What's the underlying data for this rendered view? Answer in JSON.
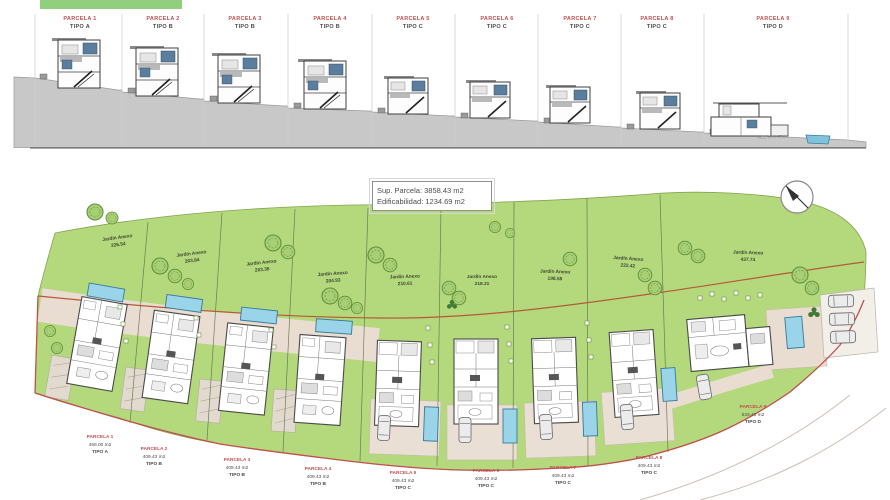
{
  "elevations": {
    "panels": [
      {
        "parcela": "PARCELA 1",
        "tipo": "TIPO A"
      },
      {
        "parcela": "PARCELA 2",
        "tipo": "TIPO B"
      },
      {
        "parcela": "PARCELA 3",
        "tipo": "TIPO B"
      },
      {
        "parcela": "PARCELA 4",
        "tipo": "TIPO B"
      },
      {
        "parcela": "PARCELA 5",
        "tipo": "TIPO C"
      },
      {
        "parcela": "PARCELA 6",
        "tipo": "TIPO C"
      },
      {
        "parcela": "PARCELA 7",
        "tipo": "TIPO C"
      },
      {
        "parcela": "PARCELA 8",
        "tipo": "TIPO C"
      },
      {
        "parcela": "PARCELA 9",
        "tipo": "TIPO D"
      }
    ],
    "note": "ACC. EXT. CRU 1"
  },
  "info_box": {
    "line1": "Sup. Parcela:  3858.43 m2",
    "line2": "Edificabilidad: 1234.69 m2"
  },
  "gardens": [
    {
      "name": "Jardín Anexo",
      "area": "226.54"
    },
    {
      "name": "Jardín Anexo",
      "area": "203.84"
    },
    {
      "name": "Jardín Anexo",
      "area": "203.36"
    },
    {
      "name": "Jardín Anexo",
      "area": "204.93"
    },
    {
      "name": "Jardín Anexo",
      "area": "210.61"
    },
    {
      "name": "Jardín Anexo",
      "area": "218.31"
    },
    {
      "name": "Jardín Anexo",
      "area": "198.58"
    },
    {
      "name": "Jardín Anexo",
      "area": "222.42"
    },
    {
      "name": "Jardín Anexo",
      "area": "437.74"
    }
  ],
  "parcels": [
    {
      "name": "PARCELA 1",
      "area": "459.00 m2",
      "tipo": "TIPO A"
    },
    {
      "name": "PARCELA 2",
      "area": "409.43 m2",
      "tipo": "TIPO B"
    },
    {
      "name": "PARCELA 3",
      "area": "409.43 m2",
      "tipo": "TIPO B"
    },
    {
      "name": "PARCELA 4",
      "area": "409.43 m2",
      "tipo": "TIPO B"
    },
    {
      "name": "PARCELA 5",
      "area": "409.43 m2",
      "tipo": "TIPO C"
    },
    {
      "name": "PARCELA 6",
      "area": "409.43 m2",
      "tipo": "TIPO C"
    },
    {
      "name": "PARCELA 7",
      "area": "409.43 m2",
      "tipo": "TIPO C"
    },
    {
      "name": "PARCELA 8",
      "area": "409.43 m2",
      "tipo": "TIPO C"
    },
    {
      "name": "PARCELA 9",
      "area": "533.40 m2",
      "tipo": "TIPO D"
    }
  ],
  "colors": {
    "site_green": "#b4d87c",
    "tree_green": "#5e8f3c",
    "pool_blue": "#9ad4e8",
    "boundary_red": "#c0504d",
    "path_brown": "#b65a36",
    "label_red": "#bf4f4f",
    "terrain_gray": "#c8c8c8",
    "window_blue": "#5b7e9e",
    "terrace_beige": "#e9ddd2"
  }
}
